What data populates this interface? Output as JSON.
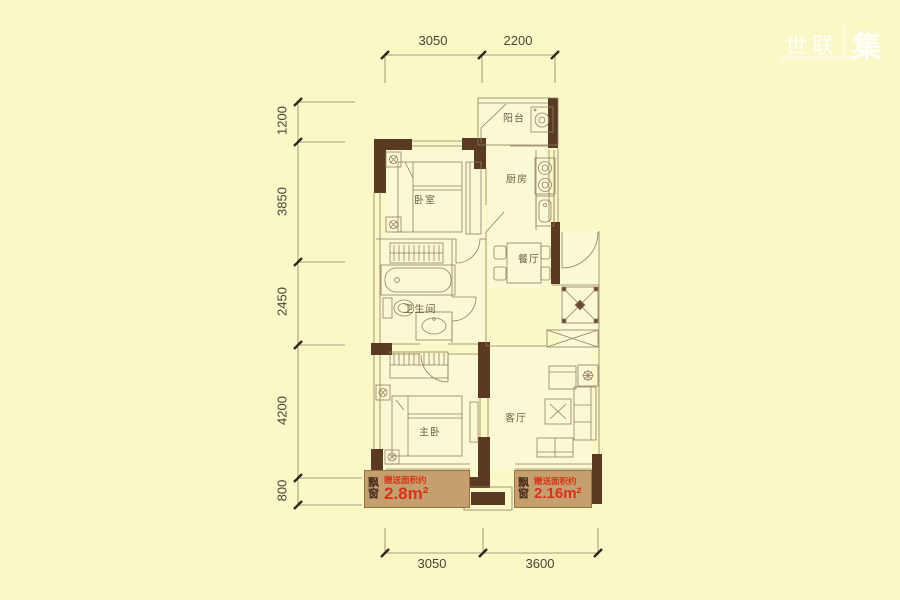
{
  "watermark": {
    "brand": "世联",
    "seal": "集"
  },
  "dimensions": {
    "top": [
      "3050",
      "2200"
    ],
    "left": [
      "1200",
      "3850",
      "2450",
      "4200",
      "800"
    ],
    "bottom": [
      "3050",
      "3600"
    ]
  },
  "rooms": {
    "balcony": {
      "label": "阳台"
    },
    "kitchen": {
      "label": "厨房"
    },
    "dining": {
      "label": "餐厅"
    },
    "bedroom": {
      "label": "卧室"
    },
    "bathroom": {
      "label": "卫生间"
    },
    "master_bedroom": {
      "label": "主卧"
    },
    "living_room": {
      "label": "客厅"
    }
  },
  "bay_windows": [
    {
      "tag": "飘窗",
      "note": "赠送面积约",
      "area": "2.8m²"
    },
    {
      "tag": "飘窗",
      "note": "赠送面积约",
      "area": "2.16m²"
    }
  ],
  "colors": {
    "background": "#FAF8C7",
    "wall": "#5B3A24",
    "line": "#8F7F63",
    "bay_fill": "#C5A06E",
    "area_text": "#D6331C",
    "dim_text": "#4C4238"
  }
}
